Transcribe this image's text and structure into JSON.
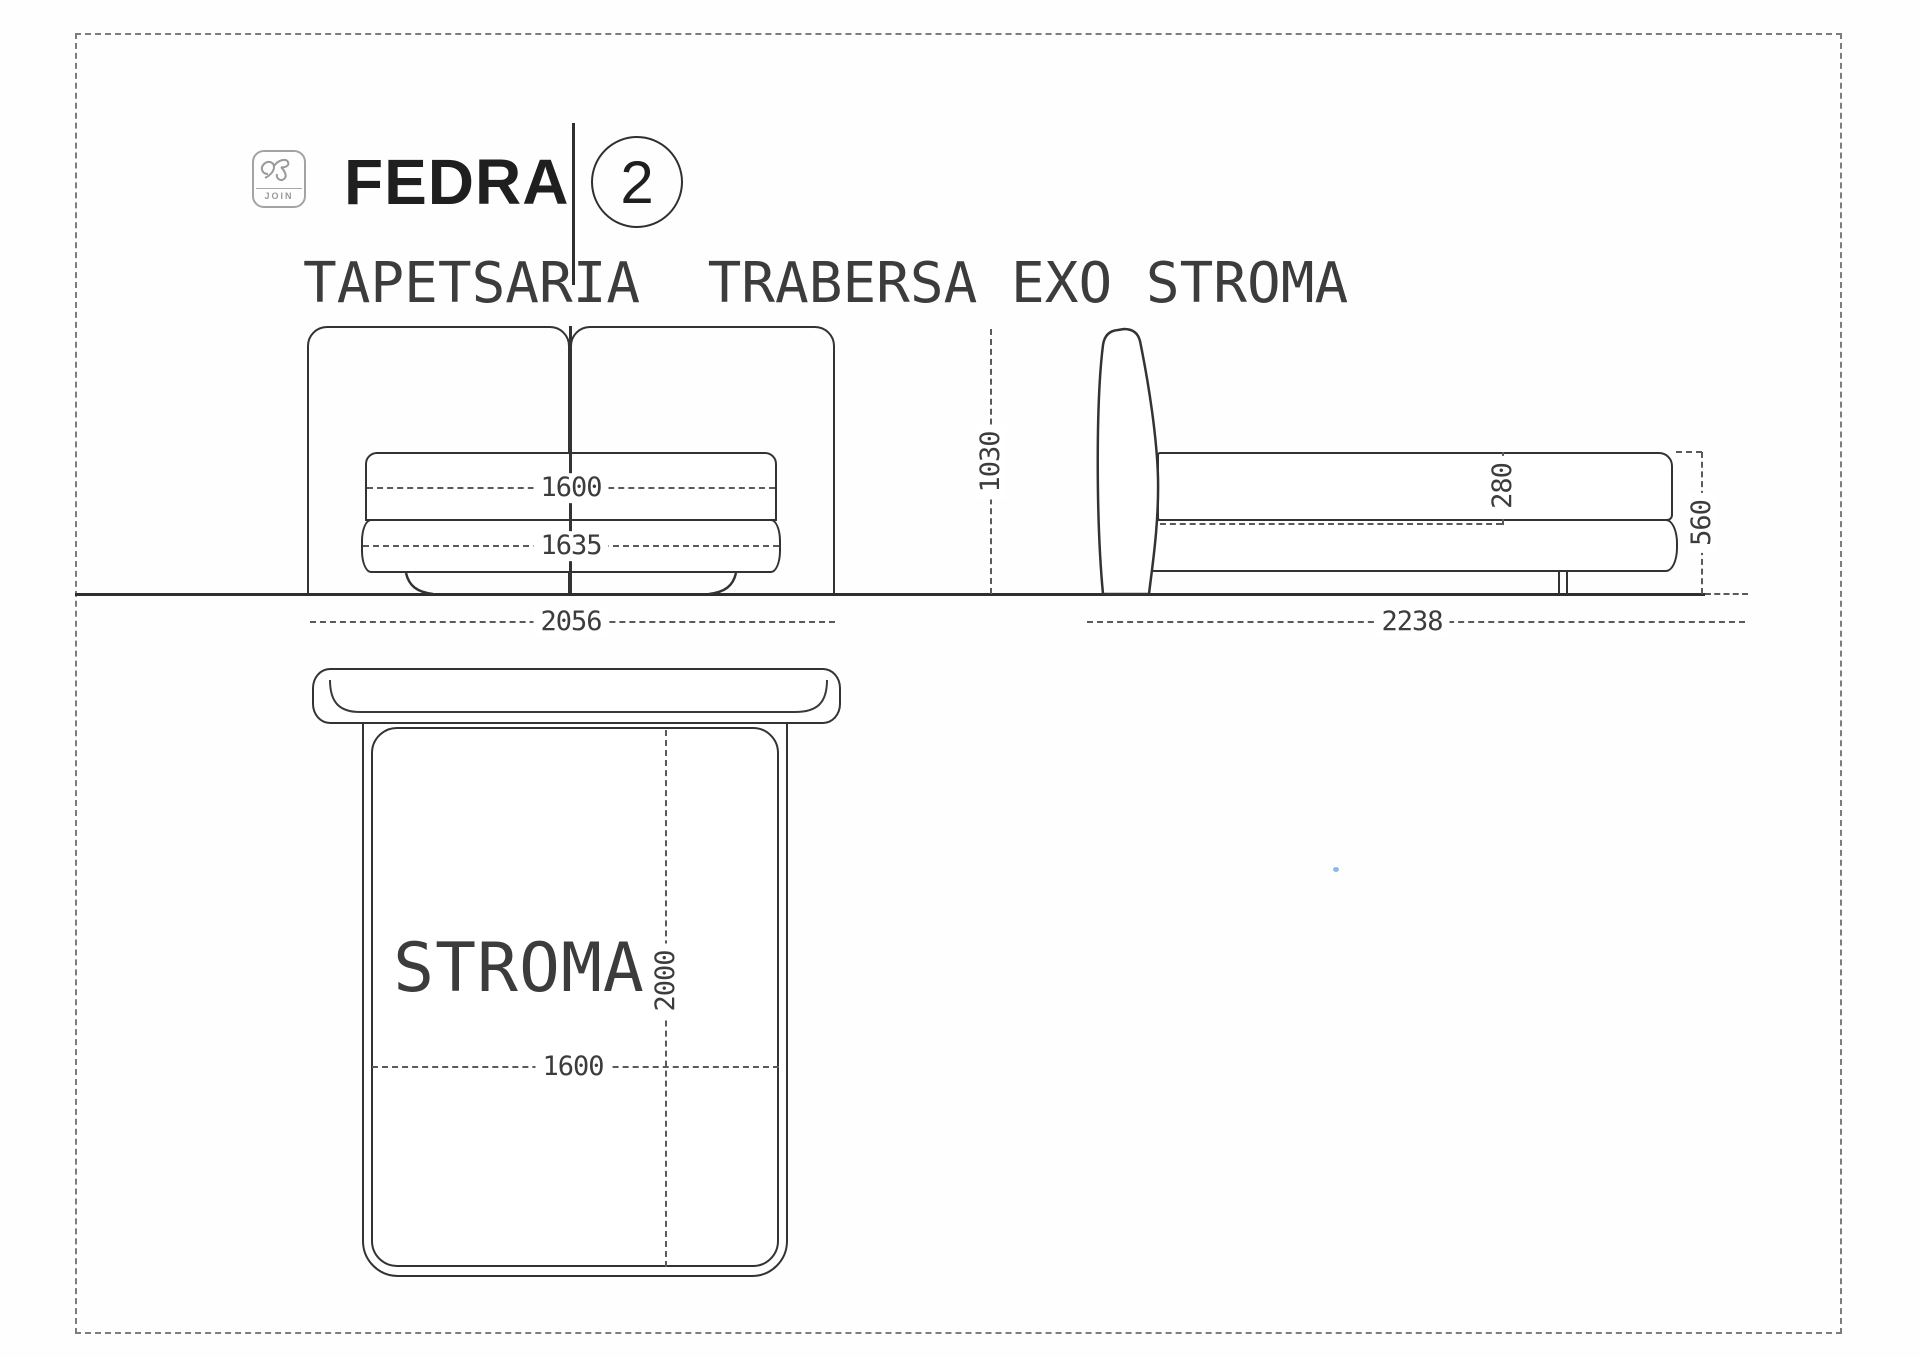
{
  "header": {
    "logo": {
      "name": "join-logo",
      "text": "JOIN"
    },
    "title": "FEDRA",
    "page_number": "2",
    "subtitle": "TAPETSARIA  TRABERSA EXO STROMA"
  },
  "drawing": {
    "front_view": {
      "mattress_width": "1600",
      "base_width": "1635",
      "overall_width": "2056"
    },
    "side_view": {
      "headboard_height": "1030",
      "mattress_thickness": "280",
      "bed_height": "560",
      "overall_length": "2238"
    },
    "top_view": {
      "mattress_label": "STROMA",
      "mattress_length": "2000",
      "mattress_width": "1600"
    }
  },
  "colors": {
    "line": "#333333",
    "dim_line": "#5a5a5a",
    "text": "#3c3c3c",
    "title": "#1f1f1f",
    "accent_dot": "#7fb2e5"
  }
}
